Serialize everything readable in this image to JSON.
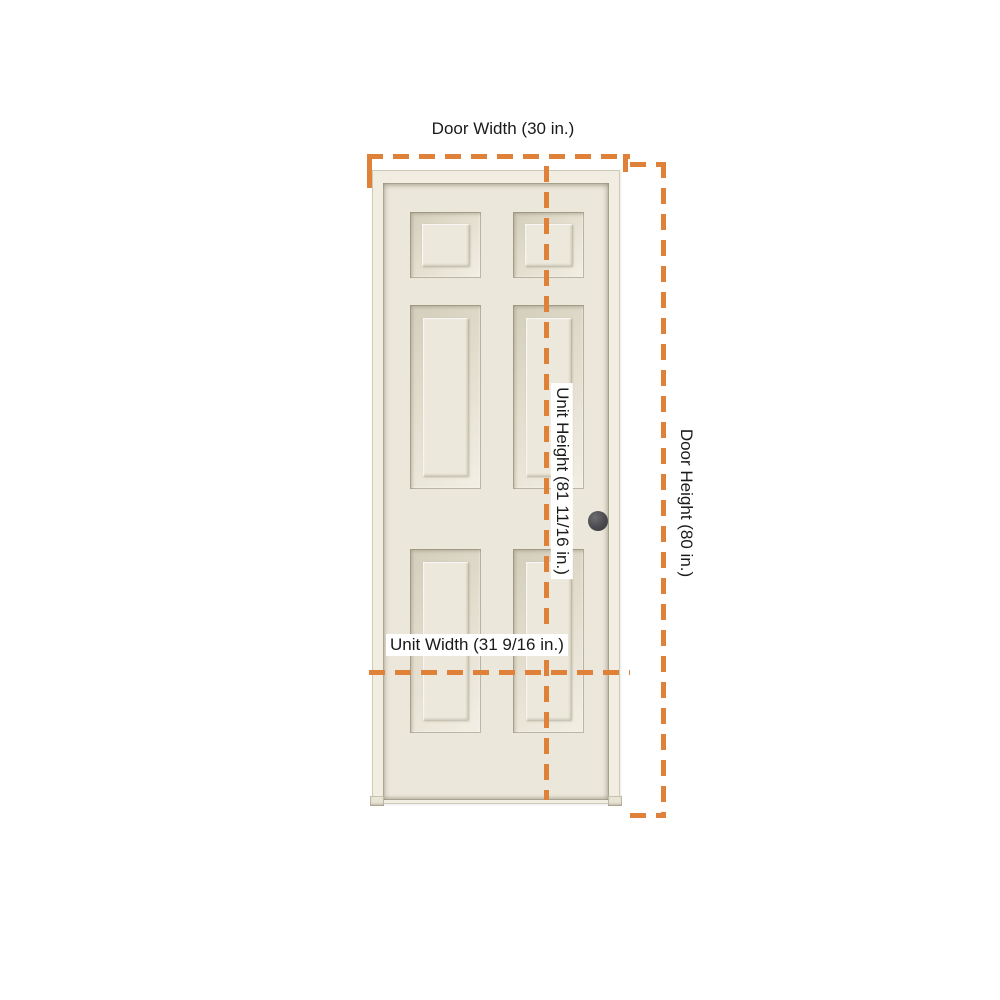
{
  "labels": {
    "door_width": "Door Width (30 in.)",
    "unit_height": "Unit Height (81 11/16 in.)",
    "door_height": "Door Height (80 in.)",
    "unit_width": "Unit Width (31 9/16 in.)"
  },
  "dimensions": {
    "door_width_in": "30",
    "unit_height_in": "81 11/16",
    "door_height_in": "80",
    "unit_width_in": "31 9/16"
  },
  "door": {
    "style": "6-panel",
    "panel_rows": 3,
    "panel_columns": 2,
    "knob_position": "right-center"
  },
  "colors": {
    "dimension_line": "#E0813A",
    "door_face": "#EBE7DA",
    "door_frame": "#F1EDE1",
    "panel_bevel_shadow": "#D3CDBB",
    "doorknob": "#47474B",
    "text": "#1A1A1A",
    "background": "#FFFFFF"
  }
}
